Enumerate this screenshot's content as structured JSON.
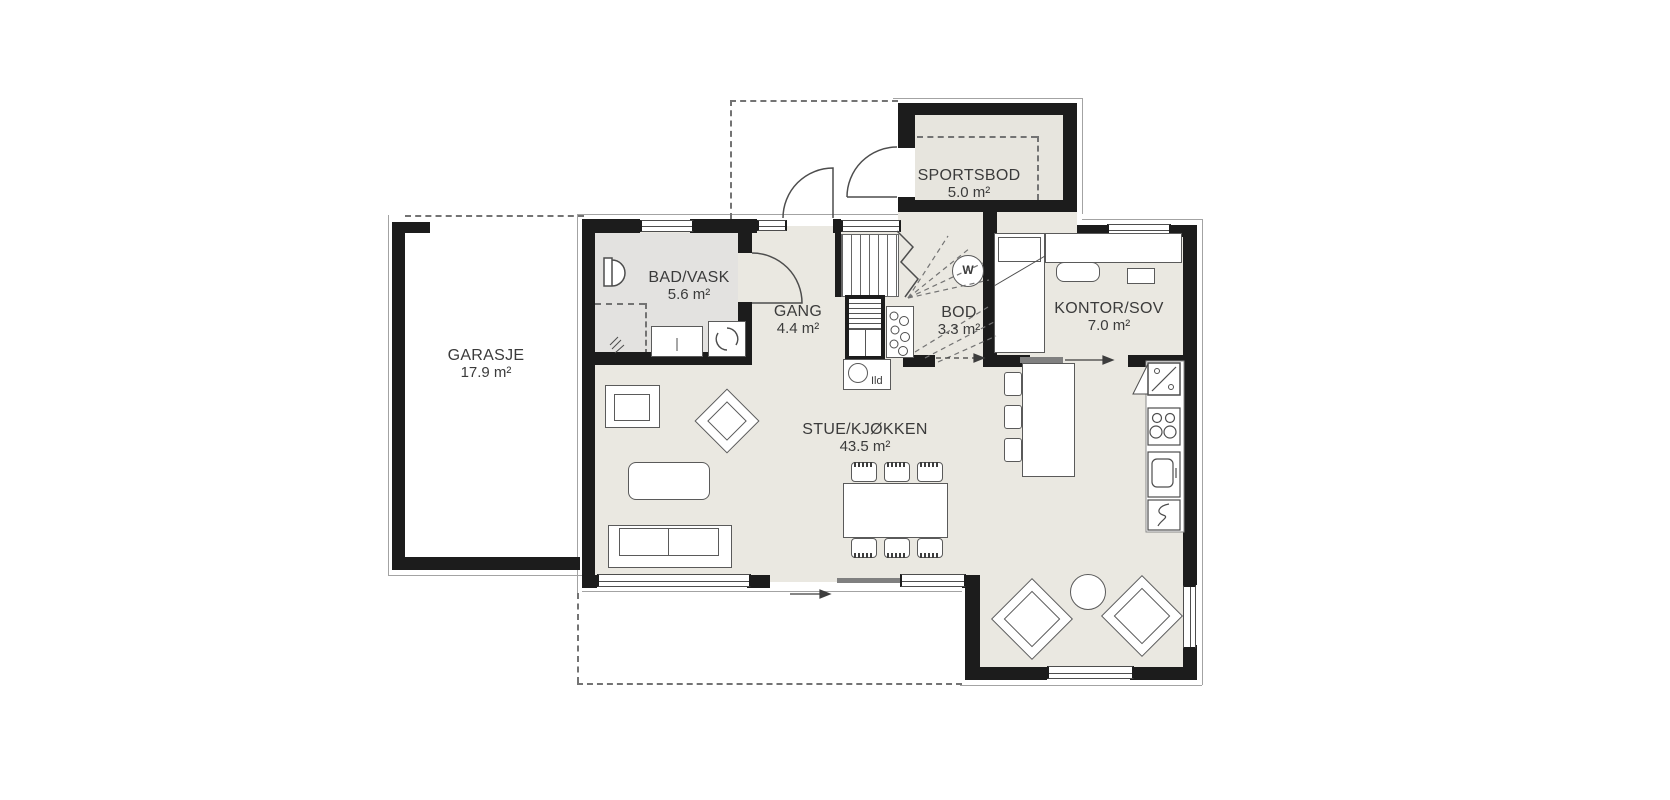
{
  "plan_type": "first-floor residential floor plan",
  "rooms": [
    {
      "name": "GARASJE",
      "area": "17.9 m²"
    },
    {
      "name": "SPORTSBOD",
      "area": "5.0 m²"
    },
    {
      "name": "BAD/VASK",
      "area": "5.6 m²"
    },
    {
      "name": "GANG",
      "area": "4.4 m²"
    },
    {
      "name": "BOD",
      "area": "3.3 m²"
    },
    {
      "name": "KONTOR/SOV",
      "area": "7.0 m²"
    },
    {
      "name": "STUE/KJØKKEN",
      "area": "43.5 m²"
    }
  ],
  "annotations": {
    "fireplace": "Ild",
    "water_heater": "W"
  },
  "colors": {
    "wall": "#1c1c1c",
    "room_fill": "#eae8e1",
    "bath_fill": "#e3e2e0",
    "sportsbod_fill": "#e7e5de",
    "line": "#4d4d4d",
    "dashed_line": "#737373",
    "background": "#ffffff",
    "text": "#3b3b3b"
  }
}
